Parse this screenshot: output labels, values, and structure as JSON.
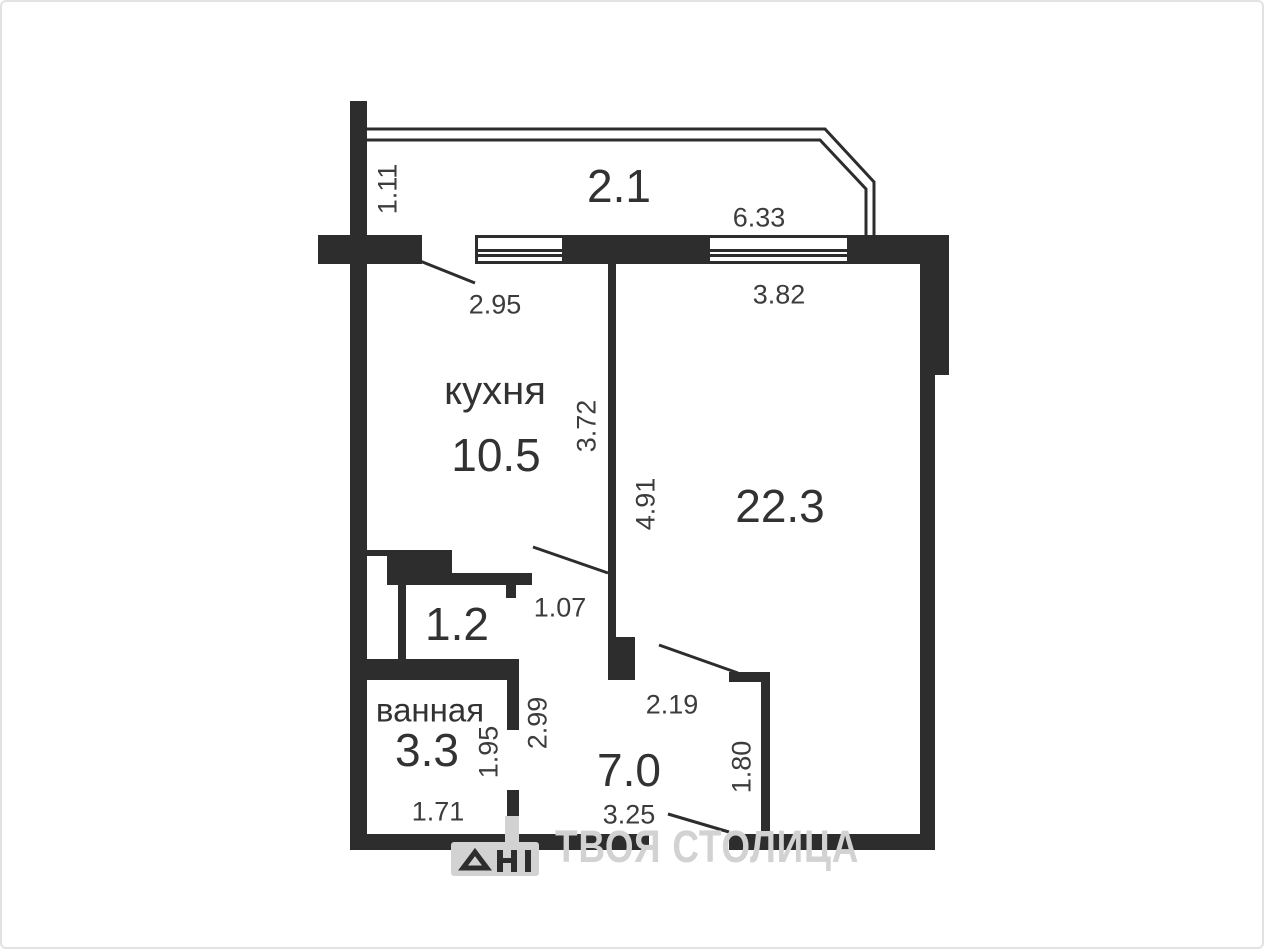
{
  "canvas": {
    "background": "#ffffff",
    "wall_color": "#2d2d2d",
    "text_color": "#333333",
    "watermark_color": "#d2d2d2"
  },
  "plan": {
    "rooms": {
      "balcony": {
        "area": "2.1"
      },
      "kitchen": {
        "name": "кухня",
        "area": "10.5"
      },
      "living": {
        "area": "22.3"
      },
      "closet": {
        "area": "1.2"
      },
      "bathroom": {
        "name": "ванная",
        "area": "3.3"
      },
      "hallway": {
        "area": "7.0"
      }
    },
    "dimensions": {
      "balcony_depth": "1.11",
      "kitchen_top": "2.95",
      "balcony_window": "6.33",
      "living_width": "3.82",
      "kitchen_depth": "3.72",
      "living_depth": "4.91",
      "kitchen_door": "1.07",
      "hallway_top": "2.19",
      "hallway_depth": "2.99",
      "bathroom_depth": "1.95",
      "bathroom_width": "1.71",
      "hallway_right": "1.80",
      "hallway_width": "3.25"
    }
  },
  "watermark": {
    "text": "ТВОЯ СТОЛИЦА"
  }
}
